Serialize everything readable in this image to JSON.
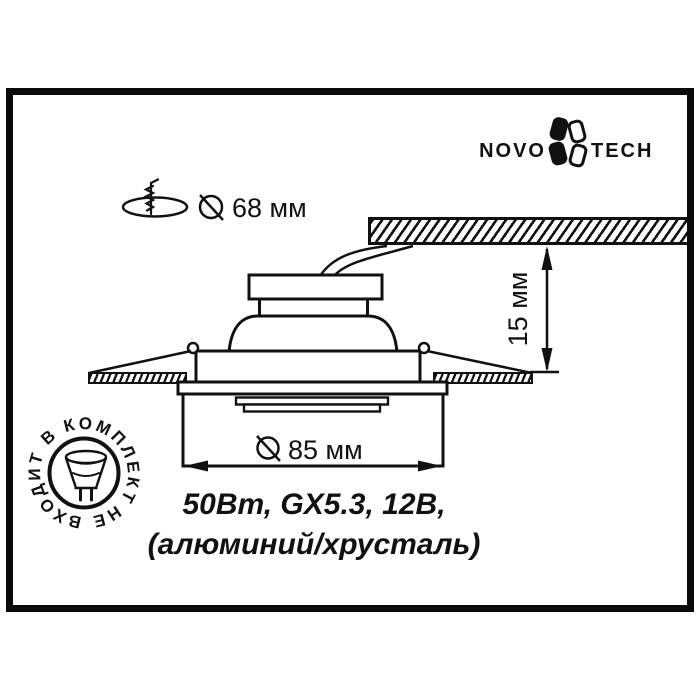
{
  "brand": {
    "left": "NOVO",
    "right": "TECH"
  },
  "callouts": {
    "cutout_diameter": "68 мм",
    "visible_diameter": "85 мм",
    "protrusion_height": "15 мм"
  },
  "specs": {
    "power_lamp_voltage": "50Вт, GX5.3, 12В,",
    "materials": "(алюминий/хрусталь)"
  },
  "stamp": {
    "lamp_not_included": "НЕ ВХОДИТ В КОМПЛЕКТ"
  },
  "colors": {
    "ink": "#111111",
    "background": "#ffffff"
  }
}
